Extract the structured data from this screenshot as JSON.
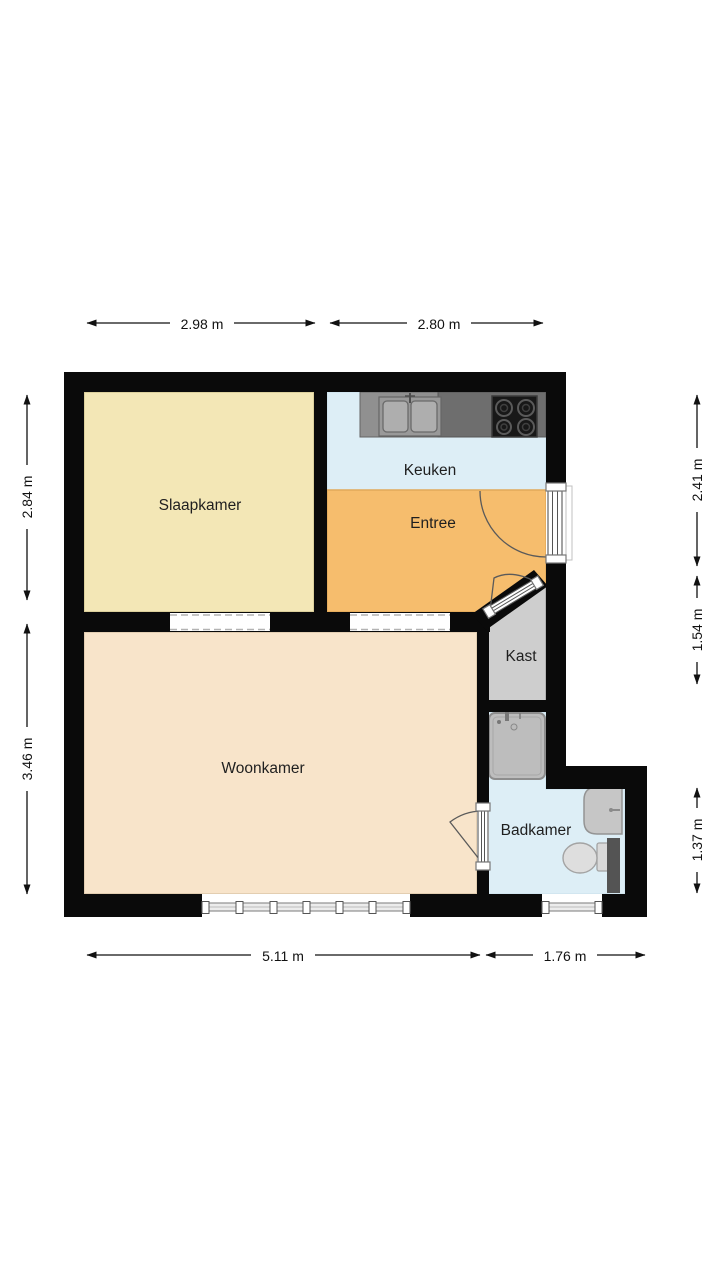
{
  "plan": {
    "title": "floor-plan",
    "rooms": {
      "slaapkamer": {
        "label": "Slaapkamer"
      },
      "keuken": {
        "label": "Keuken"
      },
      "entree": {
        "label": "Entree"
      },
      "kast": {
        "label": "Kast"
      },
      "woonkamer": {
        "label": "Woonkamer"
      },
      "badkamer": {
        "label": "Badkamer"
      }
    },
    "dimensions": {
      "top": [
        {
          "label": "2.98 m"
        },
        {
          "label": "2.80 m"
        }
      ],
      "bottom": [
        {
          "label": "5.11 m"
        },
        {
          "label": "1.76 m"
        }
      ],
      "left": [
        {
          "label": "2.84 m"
        },
        {
          "label": "3.46 m"
        }
      ],
      "right": [
        {
          "label": "2.41 m"
        },
        {
          "label": "1.54 m"
        },
        {
          "label": "1.37 m"
        }
      ]
    },
    "colors": {
      "wall": "#0a0a0a",
      "slaapkamer": "#f3e7b6",
      "keuken": "#ddeef6",
      "entree": "#f6bd6d",
      "woonkamer": "#f8e4ca",
      "kast": "#cecece",
      "badkamer": "#ddeef6",
      "counter_light": "#909090",
      "counter_dark": "#6e6e6e",
      "sink_surround": "#999999",
      "basin": "#aeaeae",
      "cooktop": "#181818",
      "shower": "#bdbdbd",
      "fixture": "#c6c6c6",
      "toilet": "#dedede",
      "radiator": "#545454"
    }
  }
}
